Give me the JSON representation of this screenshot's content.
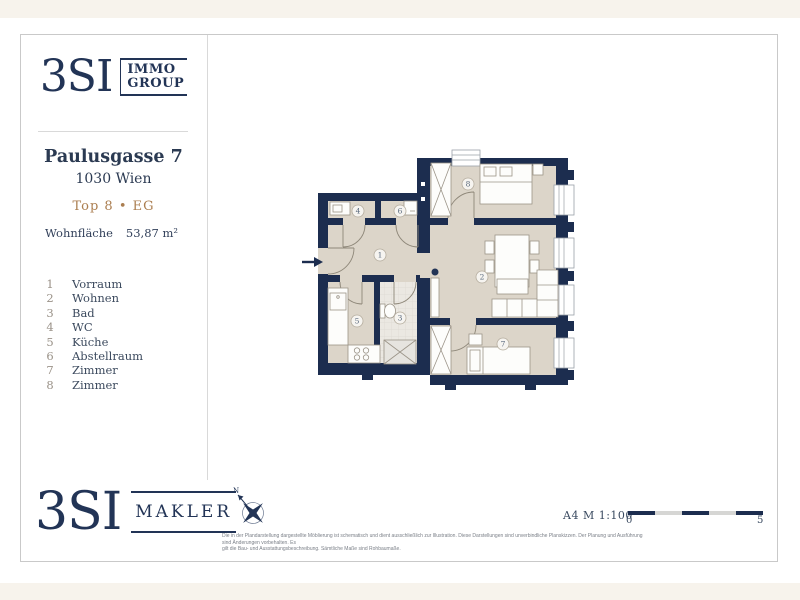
{
  "colors": {
    "navy": "#1c2d4f",
    "beige": "#dcd5c9",
    "tan": "#ab7e50",
    "page_background": "#f7f3ec"
  },
  "brand_top": {
    "name": "3SI",
    "sub_line1": "IMMO",
    "sub_line2": "GROUP"
  },
  "property": {
    "street": "Paulusgasse 7",
    "city": "1030 Wien",
    "unit": "Top 8 • EG"
  },
  "area": {
    "label": "Wohnfläche",
    "value": "53,87 m²"
  },
  "legend": {
    "items": [
      {
        "num": "1",
        "label": "Vorraum"
      },
      {
        "num": "2",
        "label": "Wohnen"
      },
      {
        "num": "3",
        "label": "Bad"
      },
      {
        "num": "4",
        "label": "WC"
      },
      {
        "num": "5",
        "label": "Küche"
      },
      {
        "num": "6",
        "label": "Abstellraum"
      },
      {
        "num": "7",
        "label": "Zimmer"
      },
      {
        "num": "8",
        "label": "Zimmer"
      }
    ]
  },
  "floorplan": {
    "rooms": [
      {
        "num": "1"
      },
      {
        "num": "2"
      },
      {
        "num": "3"
      },
      {
        "num": "4"
      },
      {
        "num": "5"
      },
      {
        "num": "6"
      },
      {
        "num": "7"
      },
      {
        "num": "8"
      }
    ]
  },
  "footer": {
    "brand": {
      "name": "3SI",
      "sub": "MAKLER"
    },
    "compass_north": "N",
    "scale_text": "A4 M 1:100",
    "scale_start": "0",
    "scale_end": "5",
    "disclaimer_line1": "Die in der Plandarstellung dargestellte Möblierung ist schematisch und dient ausschließlich zur Illustration. Diese Darstellungen sind unverbindliche Planskizzen. Der Planung und Ausführung sind Änderungen vorbehalten. Es",
    "disclaimer_line2": "gilt die Bau- und Ausstattungsbeschreibung. Sämtliche Maße sind Rohbaumaße."
  }
}
